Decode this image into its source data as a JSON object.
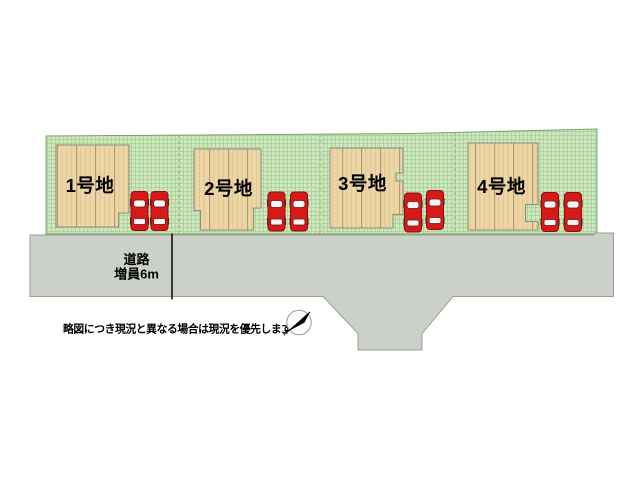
{
  "plan": {
    "title": "分譲地区画図",
    "lots": [
      {
        "label": "1号地",
        "parking_spaces": 2
      },
      {
        "label": "2号地",
        "parking_spaces": 2
      },
      {
        "label": "3号地",
        "parking_spaces": 2
      },
      {
        "label": "4号地",
        "parking_spaces": 2
      }
    ],
    "road": {
      "label": [
        "道路",
        "増員6m"
      ]
    },
    "disclaimer": "略図につき現況と異なる場合は現況を優先します",
    "compass": {
      "label": "N",
      "direction": "northeast"
    }
  },
  "colors": {
    "background": "#ffffff",
    "grass_base": "#cfe7bf",
    "grass_grid": "#a8cf97",
    "grass_border": "#7ea26f",
    "house_base": "#edd6a5",
    "house_grain": "#dfc28e",
    "house_plank": "#b1976c",
    "house_border": "#8d8d7b",
    "road_fill": "#cbd1c8",
    "road_border": "#9ba196",
    "lot_boundary": "#93b584",
    "car_body": "#d61a1a",
    "car_outline": "#8b0f0f",
    "car_window": "#f4f4f4",
    "text": "#000000"
  }
}
